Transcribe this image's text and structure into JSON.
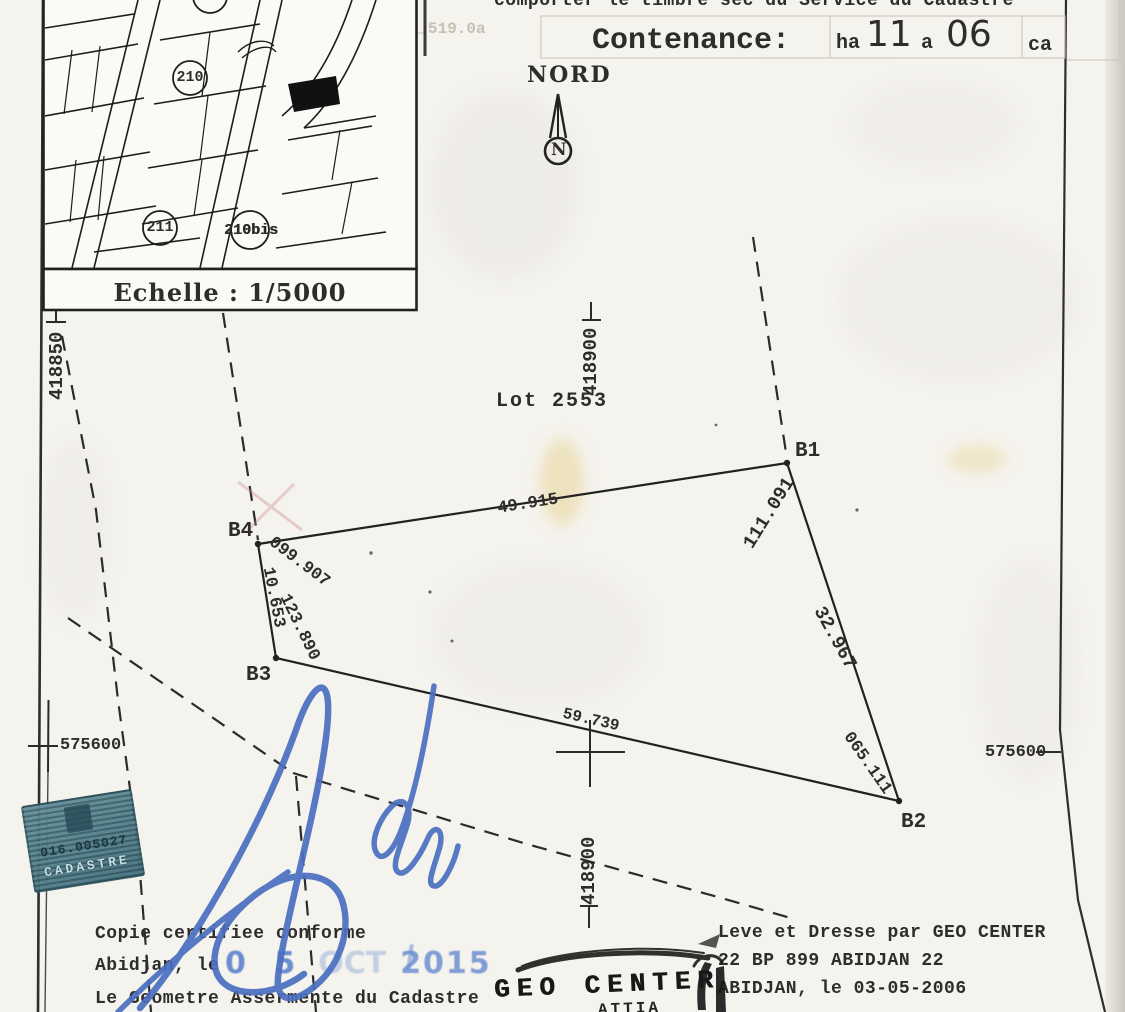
{
  "document": {
    "top_note": "comporter le timbre sec du Service du Cadastre",
    "faint_mark": "519.0a",
    "contenance": {
      "label": "Contenance:",
      "ha_label": "ha",
      "ha_value": "11",
      "a_label": "a",
      "a_value": "06",
      "ca_label": "ca"
    },
    "inset_map": {
      "scale_caption": "Echelle : 1/5000",
      "parcel_210": "210",
      "parcel_211": "211",
      "parcel_210bis": "210bis"
    },
    "north": {
      "label": "NORD",
      "letter": "N"
    },
    "lot_label": "Lot 2553",
    "grid": {
      "x_418850": "418850",
      "x_418900": "418900",
      "y_575600": "575600"
    },
    "parcel": {
      "points": {
        "b1": "B1",
        "b2": "B2",
        "b3": "B3",
        "b4": "B4"
      },
      "side_lengths": {
        "b4_b1": "49.915",
        "b1_b2": "32.967",
        "b3_b2": "59.739",
        "b4_b3": "10.653"
      },
      "corner_angles": {
        "b1": "111.091",
        "b2": "065.111",
        "b3": "123.890",
        "b4": "099.907"
      }
    },
    "certification": {
      "line1": "Copie certifiee conforme",
      "line2": "Abidjan, le",
      "line3": "Le Geometre Assermente du Cadastre"
    },
    "date_stamp": {
      "day": "0 5",
      "month": "OCT",
      "year": "2015"
    },
    "surveyor": {
      "line1": "Leve et Dresse par GEO CENTER",
      "line2": "22 BP 899 ABIDJAN 22",
      "line3": "ABIDJAN, le 03-05-2006"
    },
    "stamps": {
      "geo_center": "GEO CENTER",
      "geo_center_sub": "ATTIA",
      "cadastre_number": "016.005027",
      "cadastre_label": "CADASTRE"
    }
  },
  "colors": {
    "paper": "#f5f3ee",
    "ink": "#2c2c2c",
    "signature_blue": "#4a6fc0",
    "date_stamp_blue": "#6c8ed0",
    "cadastre_stamp_teal": "#4d7b86"
  }
}
